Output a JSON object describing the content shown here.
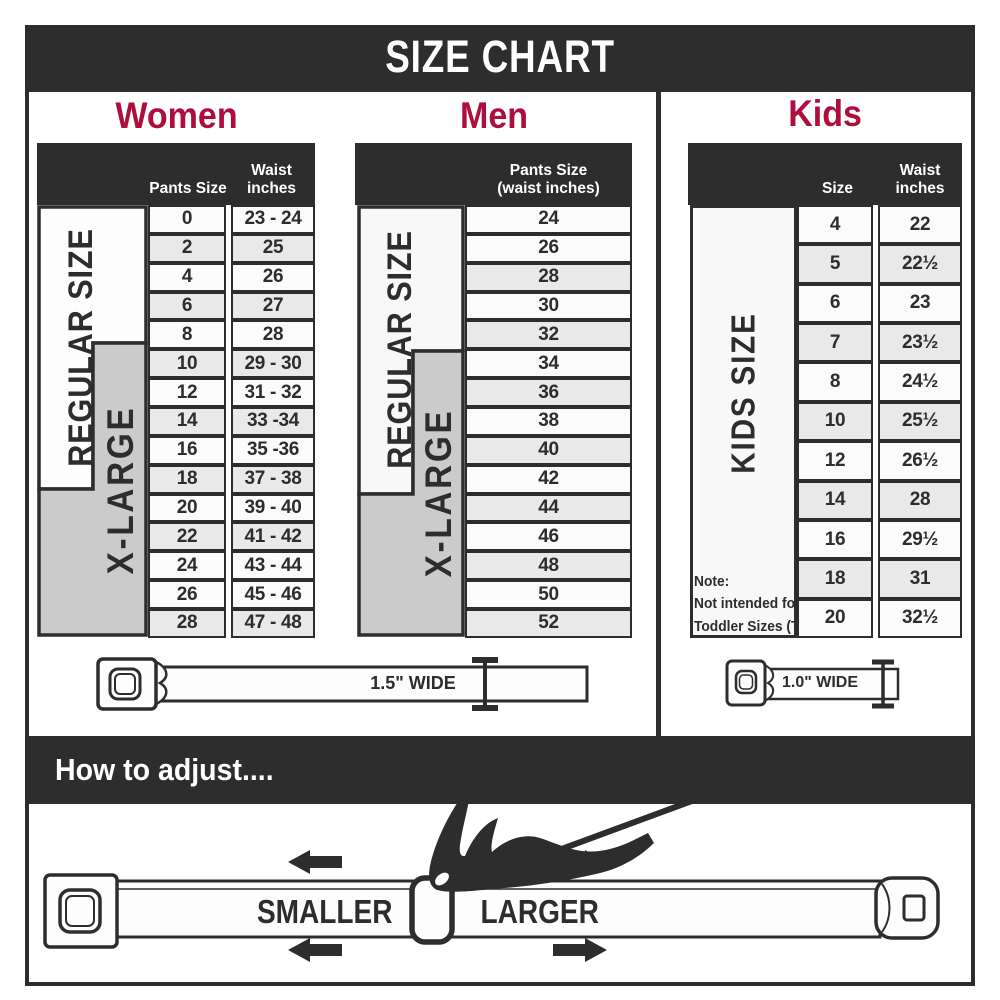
{
  "title": "SIZE CHART",
  "colors": {
    "accent_red": "#ad0e3e",
    "dark": "#2d2d2d",
    "row": "#fbfbfb",
    "row_shaded": "#e9e9e9",
    "xlarge_gray": "#cbcbcb"
  },
  "women": {
    "heading": "Women",
    "col_headers": {
      "size": "Pants Size",
      "waist_line1": "Waist",
      "waist_line2": "inches"
    },
    "side_labels": {
      "regular": "REGULAR SIZE",
      "xlarge": "X-LARGE"
    },
    "rows": [
      {
        "size": "0",
        "waist": "23 - 24",
        "shaded": false
      },
      {
        "size": "2",
        "waist": "25",
        "shaded": true
      },
      {
        "size": "4",
        "waist": "26",
        "shaded": false
      },
      {
        "size": "6",
        "waist": "27",
        "shaded": true
      },
      {
        "size": "8",
        "waist": "28",
        "shaded": false
      },
      {
        "size": "10",
        "waist": "29 - 30",
        "shaded": true
      },
      {
        "size": "12",
        "waist": "31 - 32",
        "shaded": false
      },
      {
        "size": "14",
        "waist": "33 -34",
        "shaded": true
      },
      {
        "size": "16",
        "waist": "35 -36",
        "shaded": false
      },
      {
        "size": "18",
        "waist": "37 - 38",
        "shaded": true
      },
      {
        "size": "20",
        "waist": "39 - 40",
        "shaded": false
      },
      {
        "size": "22",
        "waist": "41 - 42",
        "shaded": true
      },
      {
        "size": "24",
        "waist": "43 - 44",
        "shaded": false
      },
      {
        "size": "26",
        "waist": "45 - 46",
        "shaded": false
      },
      {
        "size": "28",
        "waist": "47 - 48",
        "shaded": true
      }
    ]
  },
  "men": {
    "heading": "Men",
    "col_headers": {
      "line1": "Pants Size",
      "line2": "(waist inches)"
    },
    "side_labels": {
      "regular": "REGULAR SIZE",
      "xlarge": "X-LARGE"
    },
    "rows": [
      {
        "size": "24",
        "shaded": false
      },
      {
        "size": "26",
        "shaded": false
      },
      {
        "size": "28",
        "shaded": true
      },
      {
        "size": "30",
        "shaded": false
      },
      {
        "size": "32",
        "shaded": true
      },
      {
        "size": "34",
        "shaded": false
      },
      {
        "size": "36",
        "shaded": true
      },
      {
        "size": "38",
        "shaded": false
      },
      {
        "size": "40",
        "shaded": true
      },
      {
        "size": "42",
        "shaded": false
      },
      {
        "size": "44",
        "shaded": true
      },
      {
        "size": "46",
        "shaded": false
      },
      {
        "size": "48",
        "shaded": true
      },
      {
        "size": "50",
        "shaded": false
      },
      {
        "size": "52",
        "shaded": true
      }
    ]
  },
  "kids": {
    "heading": "Kids",
    "col_headers": {
      "size": "Size",
      "waist_line1": "Waist",
      "waist_line2": "inches"
    },
    "side_label": "KIDS SIZE",
    "note": {
      "line1": "Note:",
      "line2": "Not intended for",
      "line3": "Toddler Sizes (T)"
    },
    "rows": [
      {
        "size": "4",
        "waist": "22",
        "shaded": false
      },
      {
        "size": "5",
        "waist": "22½",
        "shaded": true
      },
      {
        "size": "6",
        "waist": "23",
        "shaded": false
      },
      {
        "size": "7",
        "waist": "23½",
        "shaded": true
      },
      {
        "size": "8",
        "waist": "24½",
        "shaded": false
      },
      {
        "size": "10",
        "waist": "25½",
        "shaded": true
      },
      {
        "size": "12",
        "waist": "26½",
        "shaded": false
      },
      {
        "size": "14",
        "waist": "28",
        "shaded": true
      },
      {
        "size": "16",
        "waist": "29½",
        "shaded": false
      },
      {
        "size": "18",
        "waist": "31",
        "shaded": true
      },
      {
        "size": "20",
        "waist": "32½",
        "shaded": false
      }
    ]
  },
  "belts": {
    "adult_width_label": "1.5\" WIDE",
    "kids_width_label": "1.0\" WIDE"
  },
  "adjust": {
    "heading": "How to adjust....",
    "smaller_label": "SMALLER",
    "larger_label": "LARGER"
  }
}
